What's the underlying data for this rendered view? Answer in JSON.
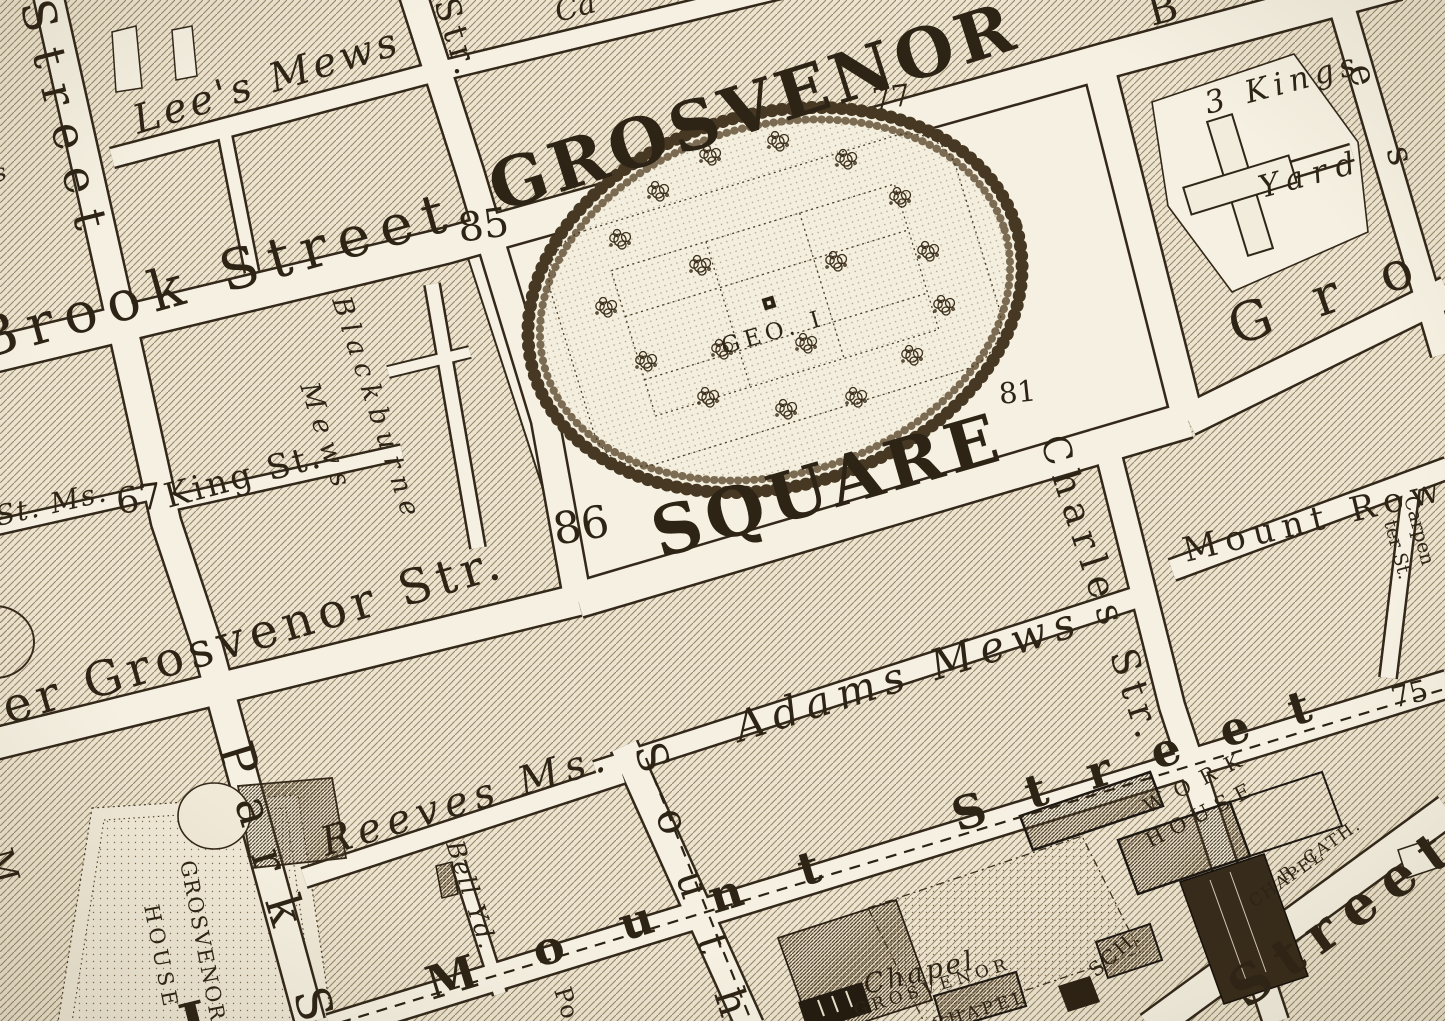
{
  "palette": {
    "paper": "#ece4d0",
    "street_fill": "#f5f0e1",
    "ink": "#2e2416",
    "casing": "#33281a",
    "hatch_line": "#9a8968",
    "dark_building": "#372b1b"
  },
  "statue_icon": "geo-i-statue-square",
  "labels": [
    {
      "id": "square-name-1",
      "text": "GROSVENOR",
      "x": 498,
      "y": 212,
      "r": -17.5,
      "s": 68,
      "ls": 5,
      "cls": "big"
    },
    {
      "id": "square-name-2",
      "text": "SQUARE",
      "x": 660,
      "y": 558,
      "r": -16,
      "s": 68,
      "ls": 6,
      "cls": "big"
    },
    {
      "id": "statue-label",
      "text": "GEO. I",
      "x": 724,
      "y": 354,
      "r": -16,
      "s": 23,
      "ls": 5,
      "cls": "caps"
    },
    {
      "id": "num-85",
      "text": "85",
      "x": 460,
      "y": 242,
      "r": -8,
      "s": 40,
      "ls": 0,
      "cls": "num"
    },
    {
      "id": "num-77",
      "text": "77",
      "x": 874,
      "y": 110,
      "r": -8,
      "s": 30,
      "ls": 0,
      "cls": "num"
    },
    {
      "id": "num-81",
      "text": "81",
      "x": 1000,
      "y": 404,
      "r": -6,
      "s": 29,
      "ls": 0,
      "cls": "num"
    },
    {
      "id": "num-86",
      "text": "86",
      "x": 556,
      "y": 545,
      "r": -10,
      "s": 44,
      "ls": 0,
      "cls": "num"
    },
    {
      "id": "num-67",
      "text": "67",
      "x": 118,
      "y": 514,
      "r": -8,
      "s": 36,
      "ls": 0,
      "cls": "num"
    },
    {
      "id": "num-75",
      "text": "75",
      "x": 1394,
      "y": 708,
      "r": -14,
      "s": 29,
      "ls": 0,
      "cls": "num"
    },
    {
      "id": "brook-street",
      "text": "Brook Street",
      "x": -18,
      "y": 360,
      "r": -15.5,
      "s": 56,
      "ls": 11,
      "cls": "street"
    },
    {
      "id": "upper-grosvenor-street",
      "text": "er Grosvenor Str.",
      "x": 8,
      "y": 724,
      "r": -16.5,
      "s": 48,
      "ls": 6,
      "cls": "street"
    },
    {
      "id": "lees-mews",
      "text": "Lee's Mews",
      "x": 138,
      "y": 134,
      "r": -17,
      "s": 40,
      "ls": 4,
      "cls": "italic"
    },
    {
      "id": "adams-mews",
      "text": "Adams Mews",
      "x": 740,
      "y": 742,
      "r": -17.5,
      "s": 42,
      "ls": 8,
      "cls": "italic"
    },
    {
      "id": "reeves-mews",
      "text": "Reeves Ms.",
      "x": 326,
      "y": 856,
      "r": -17,
      "s": 40,
      "ls": 7,
      "cls": "italic"
    },
    {
      "id": "king-street",
      "text": "King St.",
      "x": 168,
      "y": 508,
      "r": -15,
      "s": 34,
      "ls": 3,
      "cls": "street"
    },
    {
      "id": "st-ms",
      "text": "St. Ms.",
      "x": -2,
      "y": 526,
      "r": -13,
      "s": 28,
      "ls": 2,
      "cls": "italic"
    },
    {
      "id": "bell-yard",
      "text": "Bell Yd.",
      "x": 446,
      "y": 844,
      "r": 72,
      "s": 25,
      "ls": 2,
      "cls": "italic"
    },
    {
      "id": "blackburne-mews-1",
      "text": "Blackburne",
      "x": 332,
      "y": 300,
      "r": 72,
      "s": 27,
      "ls": 8,
      "cls": "italic"
    },
    {
      "id": "blackburne-mews-2",
      "text": "Mews",
      "x": 300,
      "y": 386,
      "r": 72,
      "s": 27,
      "ls": 9,
      "cls": "italic"
    },
    {
      "id": "street-left",
      "text": "Street",
      "x": 20,
      "y": 4,
      "r": 76,
      "s": 46,
      "ls": 18,
      "cls": "street"
    },
    {
      "id": "park-street",
      "text": "Park S",
      "x": 218,
      "y": 748,
      "r": 73,
      "s": 48,
      "ls": 26,
      "cls": "street"
    },
    {
      "id": "south-audley-street",
      "text": "South",
      "x": 634,
      "y": 748,
      "r": 72,
      "s": 42,
      "ls": 40,
      "cls": "street"
    },
    {
      "id": "charles-street",
      "text": "Charles Str.",
      "x": 1040,
      "y": 440,
      "r": 72,
      "s": 38,
      "ls": 8,
      "cls": "street"
    },
    {
      "id": "davies-letter-e",
      "text": "e",
      "x": 1348,
      "y": 68,
      "r": 73,
      "s": 36,
      "ls": 0,
      "cls": "street"
    },
    {
      "id": "davies-letter-s",
      "text": "s",
      "x": 1386,
      "y": 150,
      "r": 73,
      "s": 36,
      "ls": 0,
      "cls": "street"
    },
    {
      "id": "str-top",
      "text": "Str.",
      "x": 434,
      "y": 2,
      "r": 73,
      "s": 34,
      "ls": 6,
      "cls": "street"
    },
    {
      "id": "grosvenor-street-east",
      "text": "Gro",
      "x": 1236,
      "y": 346,
      "r": -19,
      "s": 54,
      "ls": 45,
      "cls": "street"
    },
    {
      "id": "mount-street-1",
      "text": "Mount",
      "x": 432,
      "y": 1000,
      "r": -17,
      "s": 46,
      "ls": 60,
      "cls": "bigst"
    },
    {
      "id": "mount-street-2",
      "text": "Street",
      "x": 958,
      "y": 832,
      "r": -17.5,
      "s": 46,
      "ls": 43,
      "cls": "bigst"
    },
    {
      "id": "south-street-corner",
      "text": "Street",
      "x": 1246,
      "y": 1010,
      "r": -36,
      "s": 54,
      "ls": 14,
      "cls": "bigst"
    },
    {
      "id": "mount-row",
      "text": "Mount Row",
      "x": 1186,
      "y": 562,
      "r": -13.5,
      "s": 34,
      "ls": 8,
      "cls": "street"
    },
    {
      "id": "carpenter-st-1",
      "text": "Carpen",
      "x": 1404,
      "y": 498,
      "r": 75,
      "s": 19,
      "ls": 0,
      "cls": "street"
    },
    {
      "id": "carpenter-st-2",
      "text": "ter St.",
      "x": 1384,
      "y": 522,
      "r": 75,
      "s": 19,
      "ls": 0,
      "cls": "street"
    },
    {
      "id": "three-kings",
      "text": "3 Kings",
      "x": 1208,
      "y": 114,
      "r": -15,
      "s": 31,
      "ls": 6,
      "cls": "italic"
    },
    {
      "id": "three-kings-yard",
      "text": "Yard",
      "x": 1262,
      "y": 198,
      "r": -15,
      "s": 31,
      "ls": 9,
      "cls": "italic"
    },
    {
      "id": "chapel",
      "text": "Chapel",
      "x": 866,
      "y": 994,
      "r": -13,
      "s": 27,
      "ls": 3,
      "cls": "italic"
    },
    {
      "id": "grosvenor-chapel-1",
      "text": "GROSVENOR",
      "x": 856,
      "y": 1016,
      "r": -17,
      "s": 17,
      "ls": 5,
      "cls": "caps"
    },
    {
      "id": "grosvenor-chapel-2",
      "text": "CHAPEL",
      "x": 934,
      "y": 1030,
      "r": -17,
      "s": 17,
      "ls": 4,
      "cls": "caps"
    },
    {
      "id": "school",
      "text": "SCH.",
      "x": 1096,
      "y": 978,
      "r": -41,
      "s": 20,
      "ls": 2,
      "cls": "caps"
    },
    {
      "id": "workhouse-1",
      "text": "WORK",
      "x": 1148,
      "y": 814,
      "r": -27,
      "s": 21,
      "ls": 12,
      "cls": "caps"
    },
    {
      "id": "workhouse-2",
      "text": "HOUSE",
      "x": 1150,
      "y": 848,
      "r": -27,
      "s": 21,
      "ls": 8,
      "cls": "caps"
    },
    {
      "id": "r-cath-chapel-1",
      "text": "R. CATH.",
      "x": 1284,
      "y": 882,
      "r": -35,
      "s": 17,
      "ls": 2,
      "cls": "caps"
    },
    {
      "id": "r-cath-chapel-2",
      "text": "CHAPEL",
      "x": 1254,
      "y": 908,
      "r": -35,
      "s": 17,
      "ls": 2,
      "cls": "caps"
    },
    {
      "id": "grosvenor-house-1",
      "text": "GROSVENOR",
      "x": 180,
      "y": 862,
      "r": 79,
      "s": 21,
      "ls": 2,
      "cls": "caps"
    },
    {
      "id": "grosvenor-house-2",
      "text": "HOUSE",
      "x": 144,
      "y": 906,
      "r": 79,
      "s": 21,
      "ls": 5,
      "cls": "caps"
    },
    {
      "id": "fragment-ca",
      "text": "Ca",
      "x": 558,
      "y": 22,
      "r": -15,
      "s": 30,
      "ls": 0,
      "cls": "italic"
    },
    {
      "id": "fragment-b",
      "text": "B",
      "x": 1152,
      "y": 26,
      "r": -15,
      "s": 40,
      "ls": 0,
      "cls": "street"
    },
    {
      "id": "fragment-l",
      "text": "L",
      "x": 186,
      "y": 1048,
      "r": -14,
      "s": 60,
      "ls": 0,
      "cls": "bigst"
    },
    {
      "id": "fragment-m",
      "text": "M",
      "x": -12,
      "y": 852,
      "r": 75,
      "s": 34,
      "ls": 0,
      "cls": "street"
    },
    {
      "id": "fragment-s",
      "text": "s",
      "x": -4,
      "y": 182,
      "r": -15,
      "s": 24,
      "ls": 0,
      "cls": "italic"
    },
    {
      "id": "fragment-po",
      "text": "Po",
      "x": 554,
      "y": 990,
      "r": 73,
      "s": 24,
      "ls": 2,
      "cls": "street"
    }
  ]
}
